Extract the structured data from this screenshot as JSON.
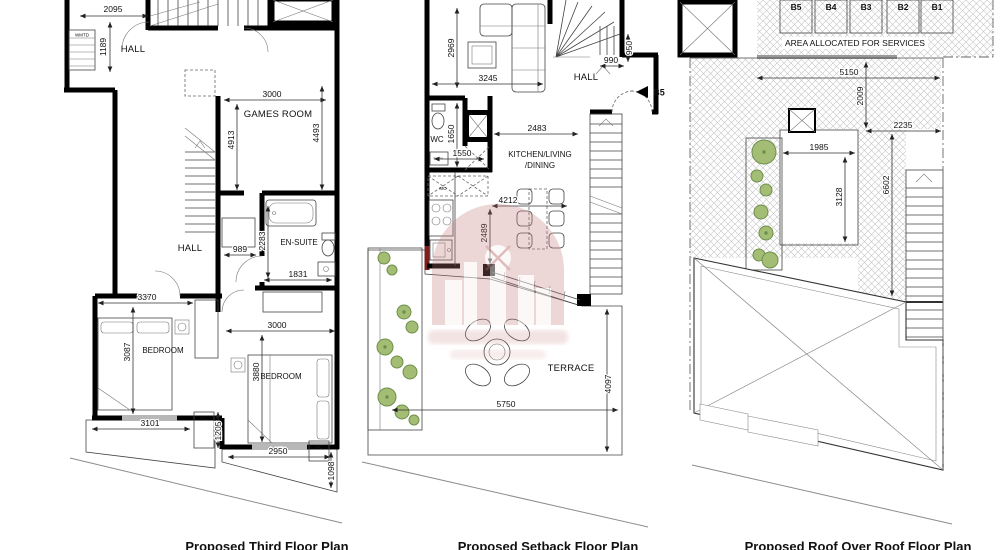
{
  "colors": {
    "wall": "#000000",
    "line": "#333333",
    "hatch": "#c4c4c4",
    "bush_fill": "#a3bd74",
    "bush_stroke": "#6e8f4b",
    "red_wall": "#7a1f1f",
    "watermark_pink": "#c17878",
    "gray_bar": "#9a9a9a"
  },
  "captions": {
    "third": "Proposed Third Floor Plan",
    "setback": "Proposed Setback Floor Plan",
    "roof": "Proposed Roof Over Roof Floor Plan"
  },
  "plan_third": {
    "labels": {
      "hall_top": "HALL",
      "wmtd": "WMTD",
      "games_room": "GAMES ROOM",
      "hall_mid": "HALL",
      "ensuite": "EN-SUITE",
      "bedroom_left": "BEDROOM",
      "bedroom_right": "BEDROOM",
      "ac_left": "AC",
      "ac_right": "AC"
    },
    "dims": {
      "d2095": "2095",
      "d1189": "1189",
      "d3000_games": "3000",
      "d4913": "4913",
      "d4493": "4493",
      "d989": "989",
      "d2283": "2283",
      "d1831": "1831",
      "d3370": "3370",
      "d3087": "3087",
      "d3000_bed": "3000",
      "d3880": "3880",
      "d3101": "3101",
      "d1205": "1205",
      "d2950": "2950",
      "d1098": "1098"
    }
  },
  "plan_setback": {
    "labels": {
      "hall": "HALL",
      "wc": "WC",
      "kitchen1": "KITCHEN/LIVING",
      "kitchen2": "/DINING",
      "terrace": "TERRACE",
      "entry_marker": "B5",
      "appliance": "MO"
    },
    "dims": {
      "d2969": "2969",
      "d3245": "3245",
      "d990": "990",
      "d950": "950",
      "d1650": "1650",
      "d1550": "1550",
      "d2483": "2483",
      "d4212": "4212",
      "d2489": "2489",
      "d5750": "5750",
      "d4097": "4097"
    }
  },
  "plan_roof": {
    "labels": {
      "b5": "B5",
      "b4": "B4",
      "b3": "B3",
      "b2": "B2",
      "b1": "B1",
      "services": "AREA ALLOCATED FOR SERVICES"
    },
    "dims": {
      "d5150": "5150",
      "d2009": "2009",
      "d2235": "2235",
      "d1985": "1985",
      "d3128": "3128",
      "d6602": "6602"
    }
  }
}
